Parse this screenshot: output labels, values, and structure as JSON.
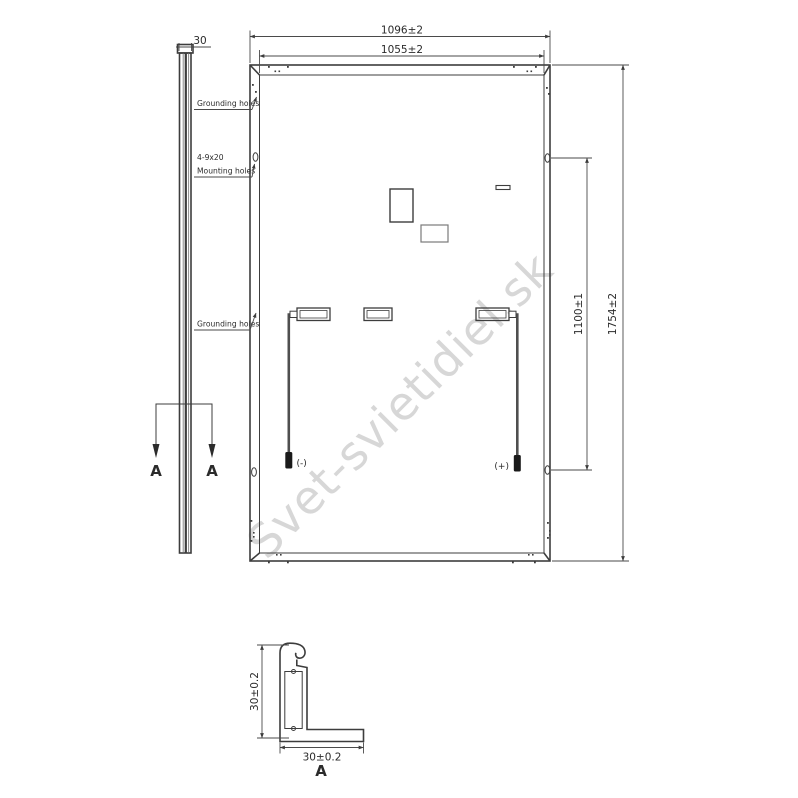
{
  "watermark": {
    "text": "Svet-svietidiel.sk",
    "color": "#d7d7d7"
  },
  "side_view": {
    "thickness_dim": "30",
    "section_label_left": "A",
    "section_label_right": "A"
  },
  "rear_view": {
    "dim_outer_width": "1096±2",
    "dim_inner_width": "1055±2",
    "dim_mounting_span": "1100±1",
    "dim_outer_height": "1754±2",
    "label_grounding_top": "Grounding holes",
    "label_mounting_line1": "4-9x20",
    "label_mounting_line2": "Mounting holes",
    "label_grounding_mid": "Grounding holes",
    "label_negative": "(-)",
    "label_positive": "(+)"
  },
  "section_detail": {
    "dim_height": "30±0.2",
    "dim_width": "30±0.2",
    "title": "A"
  },
  "colors": {
    "line": "#3d3d3d",
    "watermark": "#d7d7d7"
  }
}
